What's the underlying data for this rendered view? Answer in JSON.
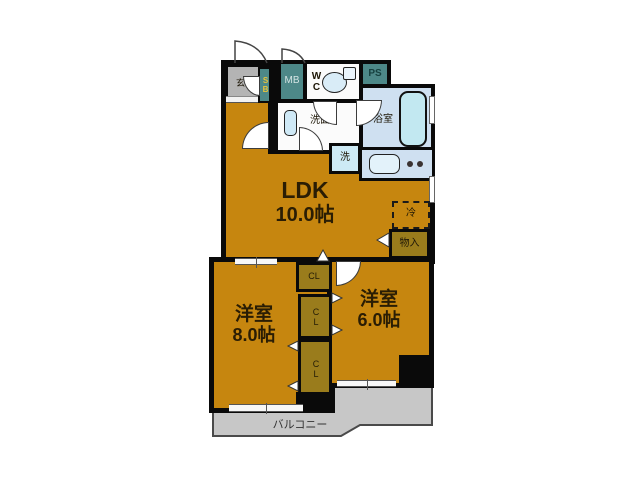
{
  "rooms": {
    "entrance": {
      "label": "玄関"
    },
    "shoe_box": {
      "label": "SB"
    },
    "meter_box": {
      "label": "MB"
    },
    "toilet": {
      "label": "WC"
    },
    "pipe_space": {
      "label": "PS"
    },
    "washroom": {
      "label": "洗面"
    },
    "bathroom": {
      "label": "浴室"
    },
    "washing_machine": {
      "label": "洗"
    },
    "ldk": {
      "label": "LDK",
      "size": "10.0帖"
    },
    "refrigerator": {
      "label": "冷"
    },
    "storage": {
      "label": "物入"
    },
    "closet_top": {
      "label": "CL"
    },
    "closet_middle": {
      "label": "CL"
    },
    "closet_bottom": {
      "label": "CL"
    },
    "western_room_left": {
      "label": "洋室",
      "size": "8.0帖"
    },
    "western_room_right": {
      "label": "洋室",
      "size": "6.0帖"
    },
    "balcony": {
      "label": "バルコニー"
    }
  },
  "icons": {
    "toilet": "toilet-icon",
    "bathtub": "bathtub-icon",
    "washbasin": "washbasin-icon",
    "kitchen_sink": "kitchen-sink-icon",
    "stove_burners": "stove-burner-dots",
    "door_arcs": "door-swing-arc",
    "closet_markers": "door-swing-triangle",
    "sliding_doors": "sliding-door-marker",
    "windows": "window-marker"
  },
  "colors": {
    "room_fill": "#c6860f",
    "closet_fill": "#9a7c1c",
    "utility_teal": "#4d8888",
    "water_area_fill": "#cfe0f1",
    "entrance_fill": "#b4b4b4",
    "balcony_fill": "#c7c7c7",
    "wall": "#0a0a0a"
  }
}
